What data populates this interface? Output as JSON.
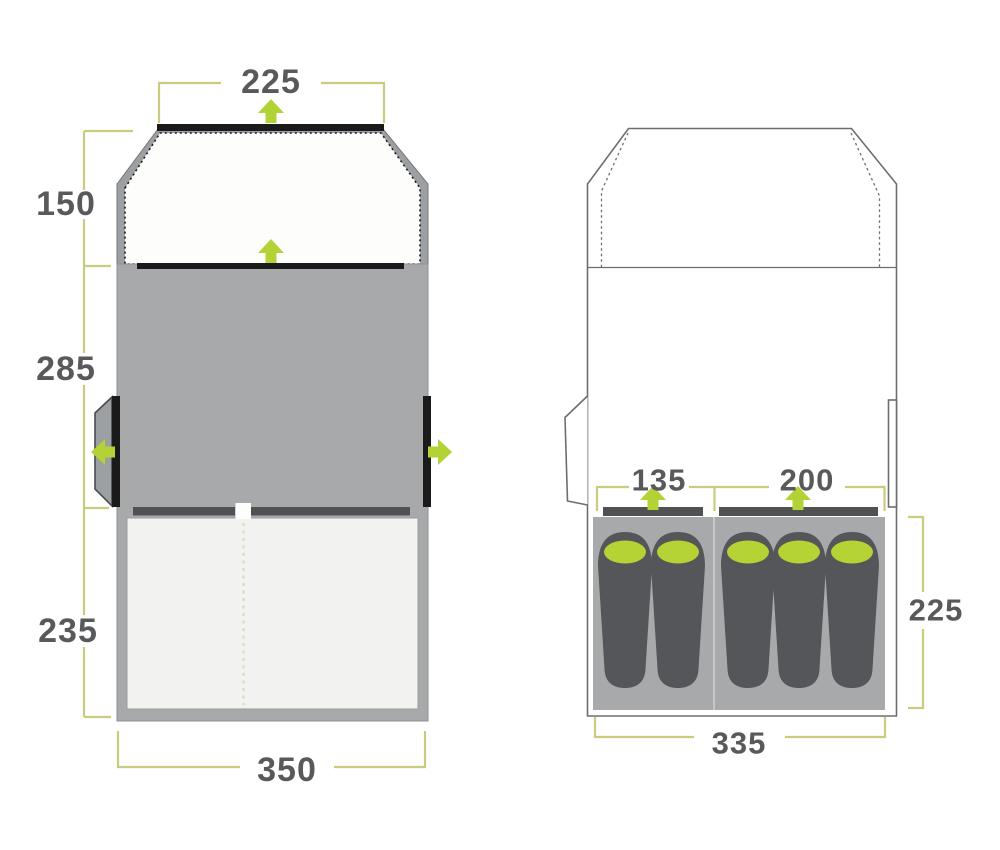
{
  "palette": {
    "dimension_text": "#58595b",
    "dimension_line": "#c9cc7f",
    "arrow_green": "#b2d235",
    "body_grey": "#a7a9ab",
    "wall_grey": "#9da0a3",
    "bar_black": "#1a1a1a",
    "bar_dark_grey": "#4f5153",
    "inner_light": "#f2f2f0",
    "porch_white": "#fdfdfb",
    "outline_grey": "#6d6e71",
    "bag_grey": "#54565a",
    "pillow_green": "#b5d334",
    "divider_cream": "#dcdbc7"
  },
  "left_floorplan": {
    "label": "tent floorplan with outer dimensions",
    "dims": {
      "front_width": "225",
      "porch_depth": "150",
      "living_depth": "285",
      "bedroom_depth": "235",
      "total_width": "350"
    }
  },
  "right_floorplan": {
    "label": "tent floorplan with sleeping layout",
    "dims": {
      "left_bedroom_width": "135",
      "right_bedroom_width": "200",
      "bedroom_depth": "225",
      "inner_width": "335"
    },
    "sleeping_bags": {
      "left_compartment": 2,
      "right_compartment": 3,
      "total": 5
    }
  },
  "icons": {
    "entrance_arrow": "entrance direction arrow"
  }
}
